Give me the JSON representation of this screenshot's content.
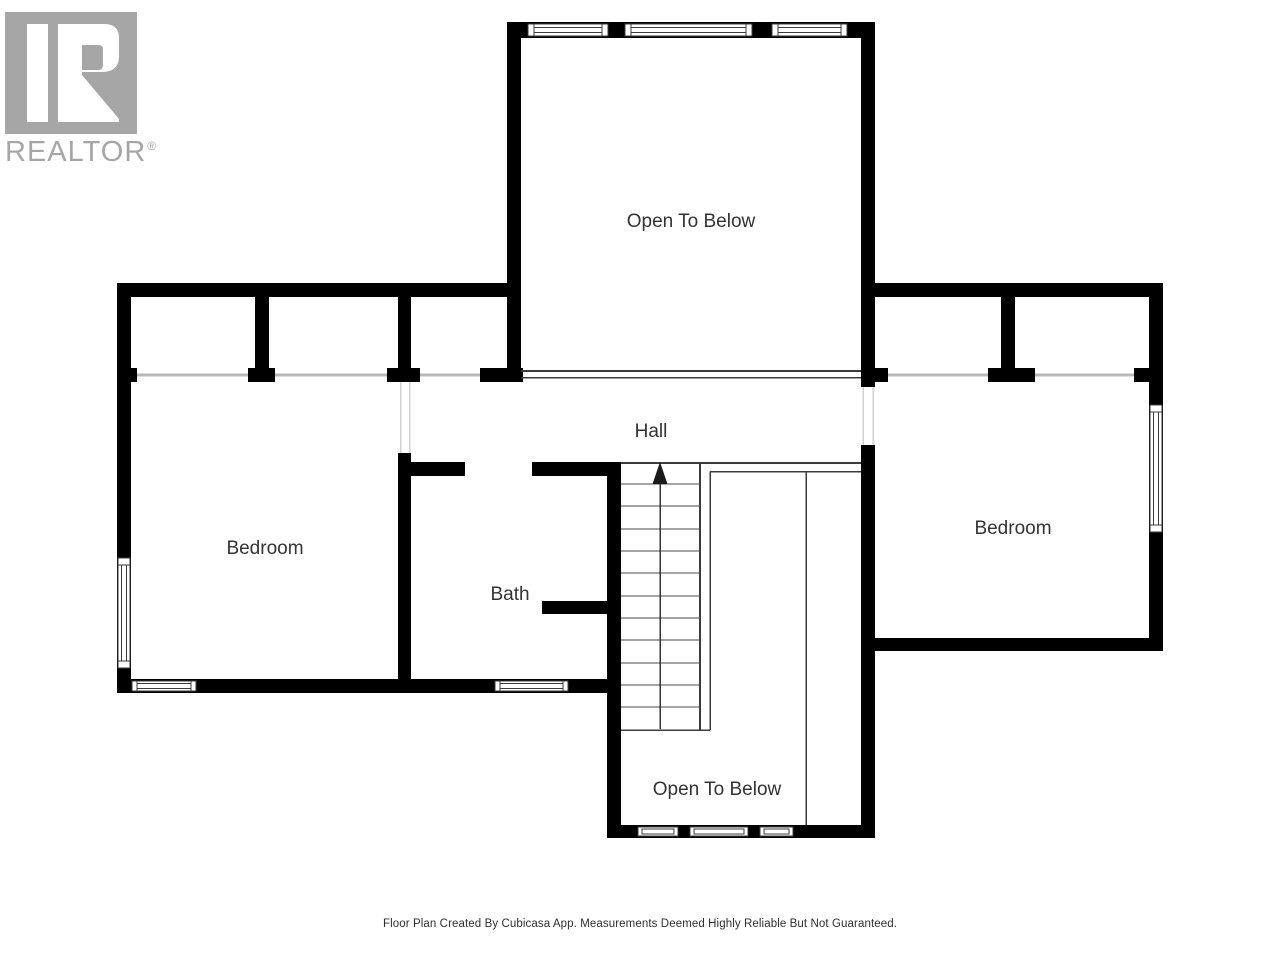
{
  "logo": {
    "brand": "REALTOR",
    "registered": "®",
    "color": "#a6a6a6"
  },
  "floor_plan": {
    "rooms": [
      {
        "id": "open-to-below-top",
        "label": "Open To Below"
      },
      {
        "id": "hall",
        "label": "Hall"
      },
      {
        "id": "bedroom-left",
        "label": "Bedroom"
      },
      {
        "id": "bath",
        "label": "Bath"
      },
      {
        "id": "bedroom-right",
        "label": "Bedroom"
      },
      {
        "id": "open-to-below-bottom",
        "label": "Open To Below"
      }
    ],
    "stairs": {
      "direction": "up"
    },
    "colors": {
      "wall": "#000000",
      "line_dark": "#3c3c3c",
      "line_light": "#b8b8b8",
      "jamb": "#d0d0d0",
      "label": "#333333",
      "background": "#ffffff",
      "logo_color": "#a6a6a6"
    }
  },
  "footer": {
    "disclaimer": "Floor Plan Created By Cubicasa App. Measurements Deemed Highly Reliable But Not Guaranteed."
  }
}
